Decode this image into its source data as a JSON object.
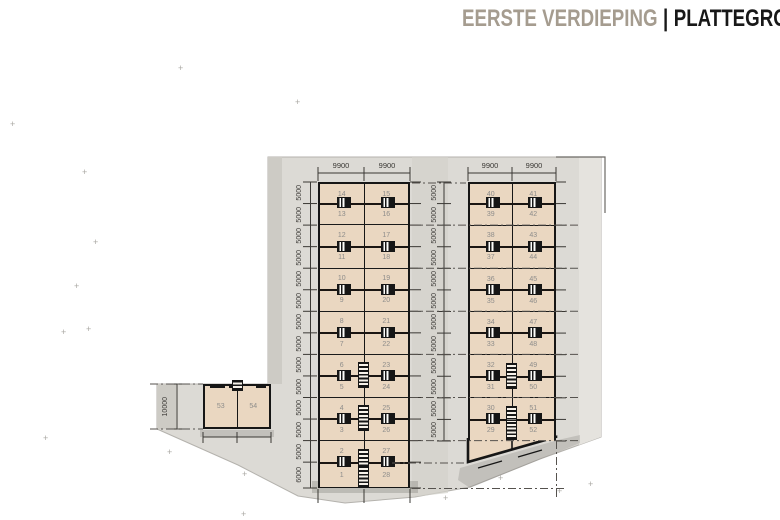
{
  "title": {
    "left": "EERSTE VERDIEPING",
    "separator": "|",
    "right": "PLATTEGROND"
  },
  "decor": {
    "cross": "+"
  },
  "buildings": {
    "left": {
      "top_dims": [
        "9900",
        "9900"
      ],
      "side_dims": [
        "5000",
        "5000",
        "5000",
        "5000",
        "5000",
        "5000",
        "5000",
        "5000",
        "5000",
        "5000",
        "5000",
        "5000",
        "5000",
        "6000"
      ],
      "rows": [
        [
          "14",
          "15"
        ],
        [
          "13",
          "16"
        ],
        [
          "12",
          "17"
        ],
        [
          "11",
          "18"
        ],
        [
          "10",
          "19"
        ],
        [
          "9",
          "20"
        ],
        [
          "8",
          "21"
        ],
        [
          "7",
          "22"
        ],
        [
          "6",
          "23"
        ],
        [
          "5",
          "24"
        ],
        [
          "4",
          "25"
        ],
        [
          "3",
          "26"
        ],
        [
          "2",
          "27"
        ],
        [
          "1",
          "28"
        ]
      ]
    },
    "right": {
      "top_dims": [
        "9900",
        "9900"
      ],
      "side_dims": [
        "5000",
        "5000",
        "5000",
        "5000",
        "5000",
        "5000",
        "5000",
        "5000",
        "5000",
        "5000",
        "5000",
        "5000"
      ],
      "rows": [
        [
          "40",
          "41"
        ],
        [
          "39",
          "42"
        ],
        [
          "38",
          "43"
        ],
        [
          "37",
          "44"
        ],
        [
          "36",
          "45"
        ],
        [
          "35",
          "46"
        ],
        [
          "34",
          "47"
        ],
        [
          "33",
          "48"
        ],
        [
          "32",
          "49"
        ],
        [
          "31",
          "50"
        ],
        [
          "30",
          "51"
        ],
        [
          "29",
          "52"
        ]
      ]
    },
    "small": {
      "side_dim": "10000",
      "units": [
        "53",
        "54"
      ]
    }
  },
  "colors": {
    "unit_fill": "#ead7c1",
    "wall": "#161616",
    "parcel": "#dcdad5",
    "parcel_dark_band": "#cdcbc5",
    "parcel_light_band": "#e5e3de",
    "dim_text": "#3f3d3a",
    "title_muted": "#a59c8f",
    "title_dark": "#181818",
    "unit_number_text": "#8e8d8b"
  }
}
